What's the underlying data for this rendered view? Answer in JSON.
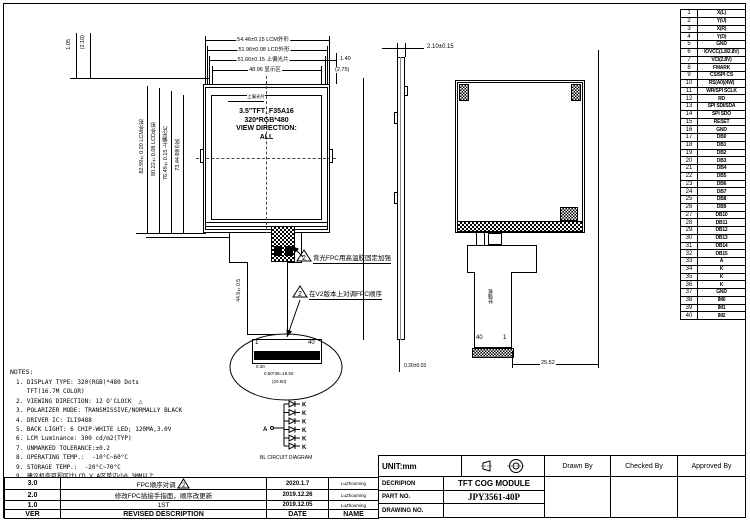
{
  "drawing": {
    "front_view": {
      "display_lines": [
        "3.5\"TFT_F35A16",
        "320*RGB*480",
        "VIEW DIRECTION:",
        "ALL"
      ],
      "polarizer_note": "上偏光片",
      "top_dims": [
        {
          "value": "54.46±0.15",
          "label": "LCM外形"
        },
        {
          "value": "51.96±0.08",
          "label": "LCD外形"
        },
        {
          "value": "51.66±0.15",
          "label": "上偏光片"
        },
        {
          "value": "48.96",
          "label": "显示区"
        }
      ],
      "top_right_dims": [
        "1.40",
        "(2.75)"
      ],
      "top_left_dims": [
        "1.05",
        "(2.10)"
      ],
      "left_dims": [
        {
          "value": "82.99±0.20",
          "label": "LCM外形"
        },
        {
          "value": "80.22±0.08",
          "label": "LCD外形"
        },
        {
          "value": "76.49±0.15",
          "label": "上偏光片"
        },
        {
          "value": "73.44",
          "label": "显示区"
        }
      ],
      "tail_length_dim": "44.9±0.5",
      "callouts": [
        {
          "marker": "2",
          "text": "背光FPC用高温胶固定加强"
        },
        {
          "marker": "2",
          "text": "在V2版本上对调FPC顺序"
        }
      ],
      "connector_detail": {
        "pin_first": "1",
        "pin_last": "40",
        "pad_dim": "0.30",
        "pitch_dim": "0.50*39=19.50",
        "total_dim": "(20.50)"
      }
    },
    "side_view": {
      "thickness_dim": "2.10±0.15",
      "fpc_thickness_dim": "0.30±0.03"
    },
    "rear_view": {
      "pin_left": "40",
      "pin_right": "1",
      "stiffener_label": "补强板",
      "fpc_width_dim": "25.52"
    }
  },
  "pin_table": {
    "rows": [
      [
        "1",
        "X(L)"
      ],
      [
        "2",
        "Y(U)"
      ],
      [
        "3",
        "X(R)"
      ],
      [
        "4",
        "Y(D)"
      ],
      [
        "5",
        "GND"
      ],
      [
        "6",
        "IOVCC(1.8/2.8V)"
      ],
      [
        "7",
        "VCI(2.8V)"
      ],
      [
        "8",
        "FMARK"
      ],
      [
        "9",
        "CS/SPI CS"
      ],
      [
        "10",
        "RS(A0)(4W)"
      ],
      [
        "11",
        "WR/SPI SCLK"
      ],
      [
        "12",
        "RD"
      ],
      [
        "13",
        "SPI SDI/SDA"
      ],
      [
        "14",
        "SPI SDO"
      ],
      [
        "15",
        "RESET"
      ],
      [
        "16",
        "GND"
      ],
      [
        "17",
        "DB0"
      ],
      [
        "18",
        "DB1"
      ],
      [
        "19",
        "DB2"
      ],
      [
        "20",
        "DB3"
      ],
      [
        "21",
        "DB4"
      ],
      [
        "22",
        "DB5"
      ],
      [
        "23",
        "DB6"
      ],
      [
        "24",
        "DB7"
      ],
      [
        "25",
        "DB8"
      ],
      [
        "26",
        "DB9"
      ],
      [
        "27",
        "DB10"
      ],
      [
        "28",
        "DB11"
      ],
      [
        "29",
        "DB12"
      ],
      [
        "30",
        "DB13"
      ],
      [
        "31",
        "DB14"
      ],
      [
        "32",
        "DB15"
      ],
      [
        "33",
        "A"
      ],
      [
        "34",
        "K"
      ],
      [
        "35",
        "K"
      ],
      [
        "36",
        "K"
      ],
      [
        "37",
        "GND"
      ],
      [
        "38",
        "IM0"
      ],
      [
        "39",
        "IM1"
      ],
      [
        "40",
        "IM2"
      ]
    ]
  },
  "notes": {
    "title": "NOTES:",
    "lines": [
      "1. DISPLAY TYPE: 320(RGB)*480 Dots",
      "   TFT(16.7M COLOR)",
      "2. VIEWING DIRECTION: 12 O'CLOCK  △",
      "3. POLARIZER MODE: TRANSMISSIVE/NORMALLY BLACK",
      "4. DRIVER IC: ILI9488",
      "5. BACK LIGHT: 6 CHIP-WHITE LED; 120MA,3.0V",
      "6. LCM Luminance: 300 cd/m2(TYP)",
      "7. UNMARKED TOLERANCE:±0.2",
      "8. OPERATING TEMP.:  -10°C~60°C",
      "9. STORAGE TEMP.:  -20°C~70°C",
      "9. 建议机壳可视区比LCD V.A区单边小0.3MM以上"
    ]
  },
  "bl_circuit": {
    "caption": "BL CIRCUIT DIAGRAM",
    "anode": "A",
    "cathode": "K"
  },
  "revision_table": {
    "headers": {
      "ver": "VER",
      "desc": "REVISED  DESCRIPTION",
      "date": "DATE",
      "name": "NAME"
    },
    "rows": [
      {
        "ver": "3.0",
        "desc": "FPC顺序对调",
        "marker": "2",
        "date": "2020.1.7",
        "name": "LuZhouming"
      },
      {
        "ver": "2.0",
        "desc": "修改FPC插接手指面，顺序改更新",
        "marker": "",
        "date": "2019.12.26",
        "name": "LuZhouming"
      },
      {
        "ver": "1.0",
        "desc": "1ST",
        "marker": "",
        "date": "2019.12.05",
        "name": "LuZhouming"
      }
    ]
  },
  "title_block": {
    "unit": "UNIT:mm",
    "drawn_by": "Drawn By",
    "checked_by": "Checked By",
    "approved_by": "Approved By",
    "description_label": "DECRIPION",
    "description_value": "TFT COG MODULE",
    "part_no_label": "PART NO.",
    "part_no_value": "JPY3561-40P",
    "drawing_no_label": "DRAWING NO.",
    "drawing_no_value": ""
  }
}
